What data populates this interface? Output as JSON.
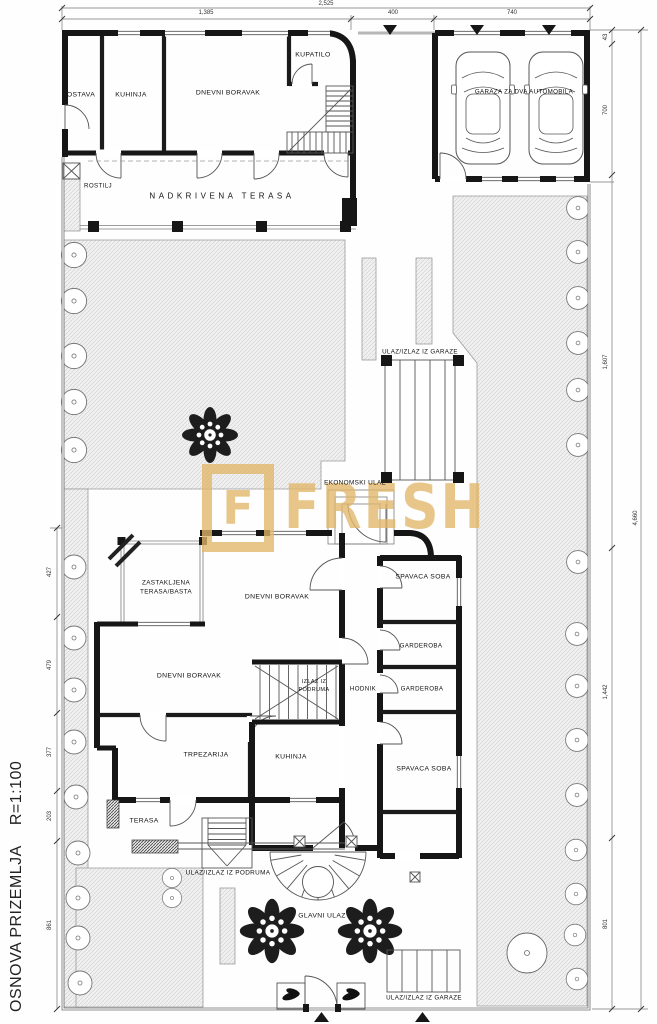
{
  "title": {
    "name": "OSNOVA PRIZEMLJA",
    "scale": "R=1:100"
  },
  "watermark": {
    "logo_letter": "F",
    "text": "FRESH",
    "color": "#e2b76a"
  },
  "rooms": {
    "ostava": "OSTAVA",
    "kuhinja_top": "KUHINJA",
    "dnevni_boravak_top": "DNEVNI BORAVAK",
    "kupatilo": "KUPATILO",
    "rostilj": "ROSTILJ",
    "nadkrivena_terasa": "NADKRIVENA TERASA",
    "garaza": "GARAZA ZA DVA AUTOMOBILA",
    "zastakljena_line1": "ZASTAKLJENA",
    "zastakljena_line2": "TERASA/BASTA",
    "dnevni_boravak_mid": "DNEVNI BORAVAK",
    "dnevni_boravak_low": "DNEVNI BORAVAK",
    "hodnik": "HODNIK",
    "spavaca_soba_1": "SPAVACA SOBA",
    "garderoba_1": "GARDEROBA",
    "garderoba_2": "GARDEROBA",
    "spavaca_soba_2": "SPAVACA SOBA",
    "trpezarija": "TRPEZARIJA",
    "kuhinja_low": "KUHINJA",
    "terasa": "TERASA"
  },
  "entrances": {
    "ulaz_izlaz_iz_garaze_top": "ULAZ/IZLAZ IZ GARAZE",
    "ekonomski_ulaz": "EKONOMSKI ULAZ",
    "izlaz_iz_podruma_line1": "IZLAZ IZ",
    "izlaz_iz_podruma_line2": "PODRUMA",
    "ulaz_izlaz_iz_podruma": "ULAZ/IZLAZ IZ PODRUMA",
    "glavni_ulaz": "GLAVNI ULAZ",
    "ulaz_izlaz_iz_garaze_bottom": "ULAZ/IZLAZ IZ GARAZE"
  },
  "dimensions": {
    "top_total": "2,525",
    "top_segments": [
      "1,385",
      "400",
      "740"
    ],
    "left_segments": [
      "427",
      "479",
      "377",
      "203",
      "861"
    ],
    "right_segments": [
      "43",
      "700",
      "1,607",
      "1,442",
      "801"
    ],
    "right_total": "4,660"
  }
}
